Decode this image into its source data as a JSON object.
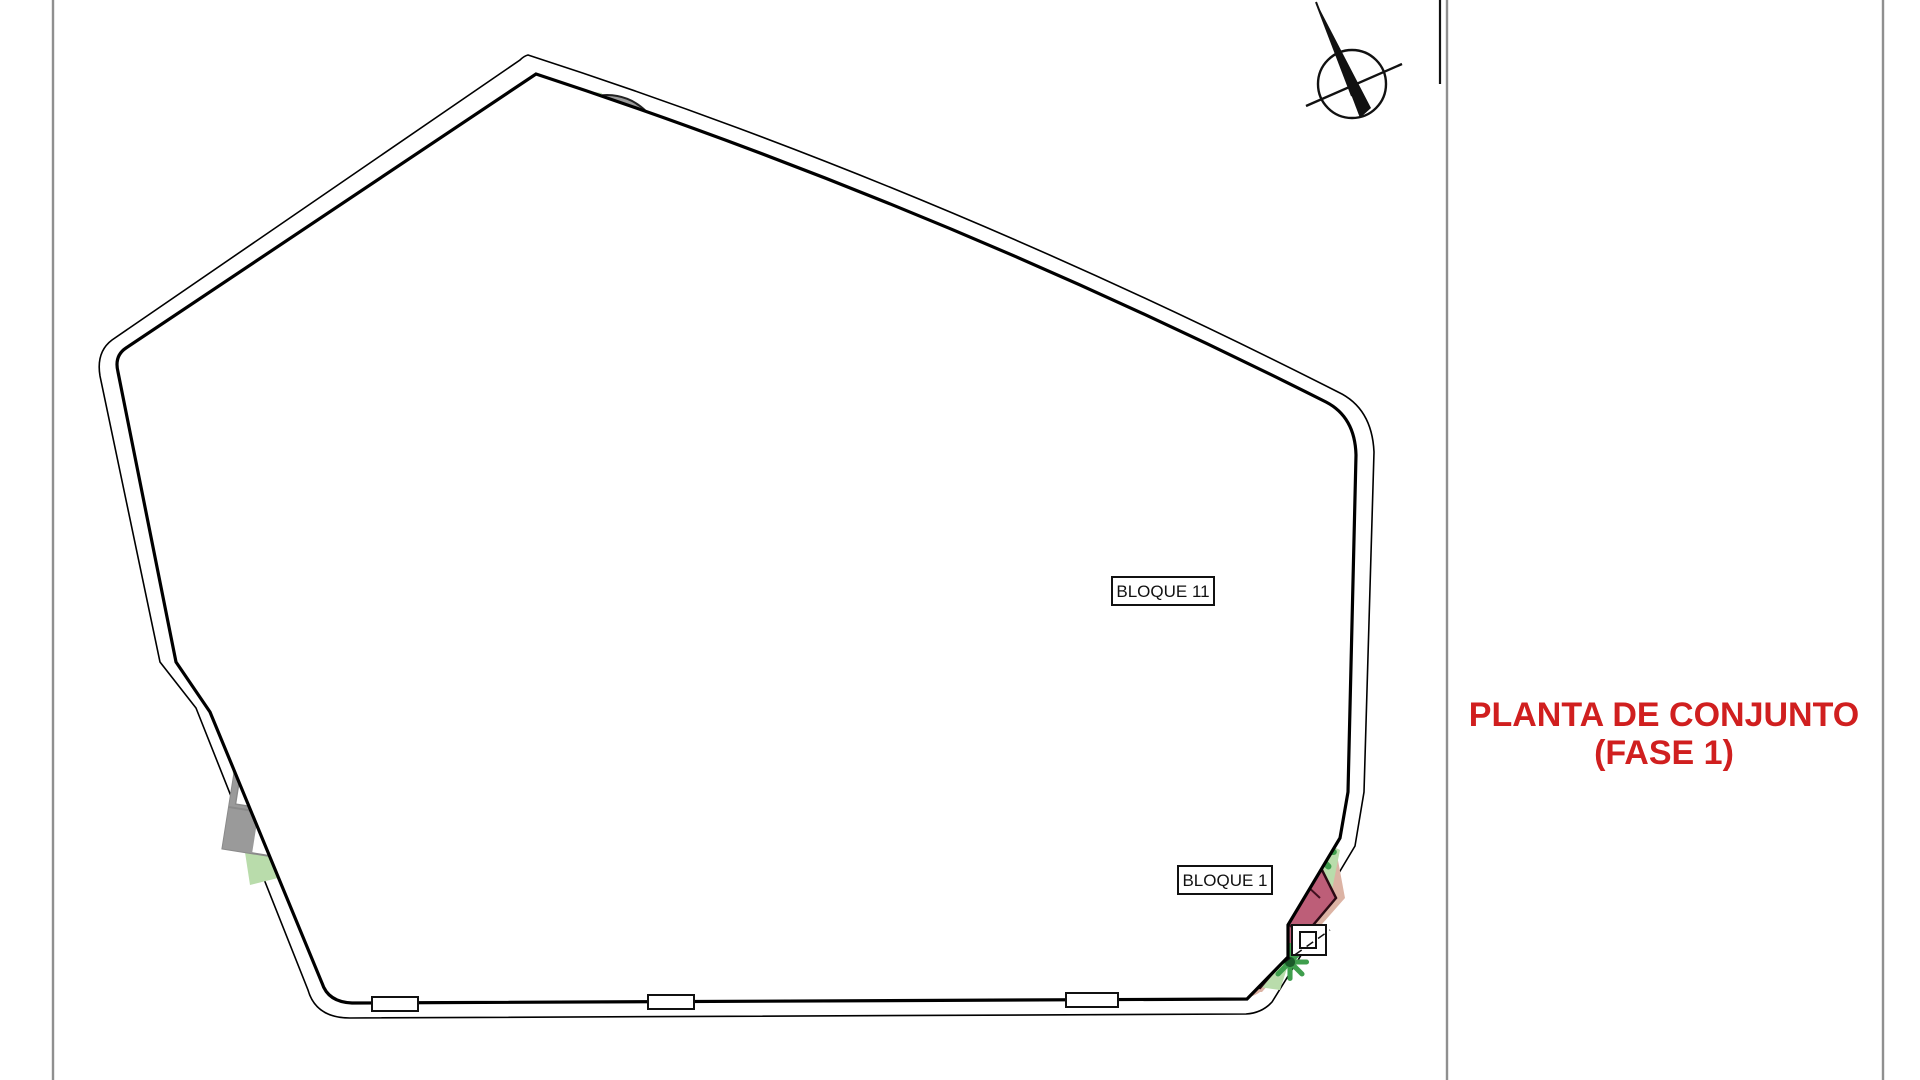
{
  "sheet": {
    "kind": "architectural site plan drawing",
    "title_line1": "PLANTA DE CONJUNTO",
    "title_line2": "(FASE 1)"
  },
  "plan": {
    "labels": {
      "bloque11": "BLOQUE 11",
      "bloque1": "BLOQUE 1"
    },
    "icons": [
      "north-compass-icon"
    ]
  },
  "colors": {
    "title-red": "#d01f1f",
    "road-pink": "#dcb3a4",
    "parking-light": "#cbcbcb",
    "parking-dark": "#8d8d8d",
    "grass-light": "#b9dcab",
    "hedge-green": "#3f9e4d",
    "tree-mid": "#2e8b3d",
    "tree-dark": "#1b5a29",
    "cream": "#f4ecc6",
    "pool-blue": "#93c1ee",
    "pool-edge": "#24457c",
    "maroon": "#bd5e78",
    "maroon-dark": "#401020",
    "building-gray": "#8a8a8a",
    "divider-gray": "#8f8f8f"
  }
}
